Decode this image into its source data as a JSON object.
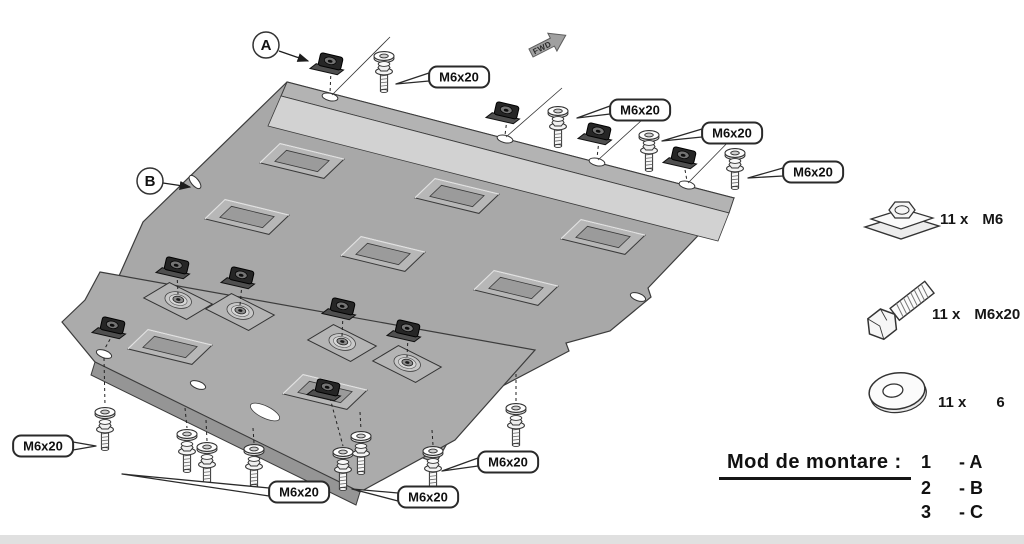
{
  "diagram": {
    "direction_arrow": {
      "label": "FWD"
    },
    "part_labels": [
      {
        "label": "A",
        "cx": 266,
        "cy": 45,
        "ax1": 279,
        "ay1": 51,
        "ax2": 308,
        "ay2": 61
      },
      {
        "label": "B",
        "cx": 150,
        "cy": 181,
        "ax1": 163,
        "ay1": 183,
        "ax2": 190,
        "ay2": 187
      }
    ],
    "fastener_callouts": [
      {
        "label": "M6x20",
        "cx": 459,
        "cy": 77,
        "tx": 396,
        "ty": 84
      },
      {
        "label": "M6x20",
        "cx": 640,
        "cy": 110,
        "tx": 577,
        "ty": 118
      },
      {
        "label": "M6x20",
        "cx": 732,
        "cy": 133,
        "tx": 662,
        "ty": 141
      },
      {
        "label": "M6x20",
        "cx": 813,
        "cy": 172,
        "tx": 748,
        "ty": 178
      },
      {
        "label": "M6x20",
        "cx": 43,
        "cy": 446,
        "tx": 96,
        "ty": 446
      },
      {
        "label": "M6x20",
        "cx": 299,
        "cy": 492,
        "tx": 122,
        "ty": 474
      },
      {
        "label": "M6x20",
        "cx": 428,
        "cy": 497,
        "tx": 352,
        "ty": 489
      },
      {
        "label": "M6x20",
        "cx": 508,
        "cy": 462,
        "tx": 442,
        "ty": 471
      }
    ]
  },
  "legend": {
    "items": [
      {
        "icon": "clip-nut",
        "qty": "11 x",
        "size": "M6"
      },
      {
        "icon": "hex-bolt",
        "qty": "11 x",
        "size": "M6x20"
      },
      {
        "icon": "washer",
        "qty": "11 x",
        "size": "6"
      }
    ]
  },
  "mounting": {
    "title": "Mod de montare :",
    "rows": [
      {
        "step": "1",
        "part": "- A"
      },
      {
        "step": "2",
        "part": "- B"
      },
      {
        "step": "3",
        "part": "- C"
      }
    ]
  },
  "geometry": {
    "plateB": "M287,82 L734,198 L648,288 L651,297 L610,331 L566,343 L569,351 L470,403 L436,463 L95,330 L143,222 Z",
    "flangeTop": "M287,82 L734,198 L729,213 L281,96 Z",
    "flangeBand": "M281,96 L729,213 L718,241 L268,126 Z",
    "plateC": "M100,272 L535,350 L455,440 L360,492 L95,362 L62,322 L85,300 Z",
    "plateCFlange": "M95,362 L360,492 L356,505 L91,375 Z",
    "vents": [
      [
        302,
        161
      ],
      [
        247,
        217
      ],
      [
        457,
        196
      ],
      [
        383,
        254
      ],
      [
        603,
        237
      ],
      [
        516,
        288
      ],
      [
        170,
        347
      ],
      [
        325,
        392
      ]
    ],
    "pads": [
      [
        178,
        301
      ],
      [
        240,
        312
      ],
      [
        342,
        343
      ],
      [
        407,
        364
      ]
    ],
    "nuts": [
      [
        331,
        62
      ],
      [
        507,
        111
      ],
      [
        599,
        132
      ],
      [
        684,
        156
      ],
      [
        177,
        266
      ],
      [
        242,
        276
      ],
      [
        343,
        307
      ],
      [
        408,
        329
      ],
      [
        113,
        326
      ],
      [
        328,
        388
      ]
    ],
    "washersTop": [
      [
        384,
        56
      ],
      [
        558,
        111
      ],
      [
        649,
        135
      ],
      [
        735,
        153
      ]
    ],
    "boltsTop": [
      [
        384,
        66
      ],
      [
        558,
        121
      ],
      [
        649,
        145
      ],
      [
        735,
        163
      ]
    ],
    "washersBottom": [
      [
        105,
        412
      ],
      [
        187,
        434
      ],
      [
        207,
        447
      ],
      [
        254,
        449
      ],
      [
        343,
        452
      ],
      [
        361,
        436
      ],
      [
        433,
        451
      ],
      [
        516,
        408
      ]
    ],
    "boltsBottom": [
      [
        105,
        424
      ],
      [
        187,
        446
      ],
      [
        207,
        459
      ],
      [
        254,
        461
      ],
      [
        343,
        464
      ],
      [
        361,
        448
      ],
      [
        433,
        463
      ],
      [
        516,
        420
      ]
    ],
    "holes": [
      [
        330,
        97,
        13
      ],
      [
        505,
        139,
        13
      ],
      [
        597,
        162,
        13
      ],
      [
        687,
        185,
        13
      ],
      [
        195,
        182,
        50
      ],
      [
        638,
        297,
        20
      ],
      [
        198,
        385,
        20
      ],
      [
        104,
        354,
        20
      ]
    ],
    "notches": [
      [
        265,
        412,
        26
      ]
    ],
    "dashed": [
      [
        331,
        70,
        330,
        93
      ],
      [
        507,
        119,
        505,
        135
      ],
      [
        599,
        140,
        597,
        158
      ],
      [
        684,
        164,
        687,
        181
      ],
      [
        177,
        274,
        178,
        294
      ],
      [
        242,
        284,
        240,
        305
      ],
      [
        343,
        315,
        342,
        336
      ],
      [
        408,
        337,
        407,
        357
      ],
      [
        113,
        334,
        104,
        350
      ],
      [
        104,
        358,
        105,
        406
      ],
      [
        185,
        408,
        187,
        428
      ],
      [
        206,
        420,
        207,
        441
      ],
      [
        253,
        428,
        254,
        443
      ],
      [
        360,
        412,
        361,
        430
      ],
      [
        432,
        430,
        433,
        445
      ],
      [
        516,
        374,
        516,
        402
      ],
      [
        330,
        398,
        343,
        446
      ]
    ],
    "thin": [
      [
        332,
        95,
        390,
        37
      ],
      [
        506,
        137,
        562,
        88
      ],
      [
        598,
        160,
        653,
        110
      ],
      [
        688,
        183,
        740,
        130
      ]
    ]
  }
}
